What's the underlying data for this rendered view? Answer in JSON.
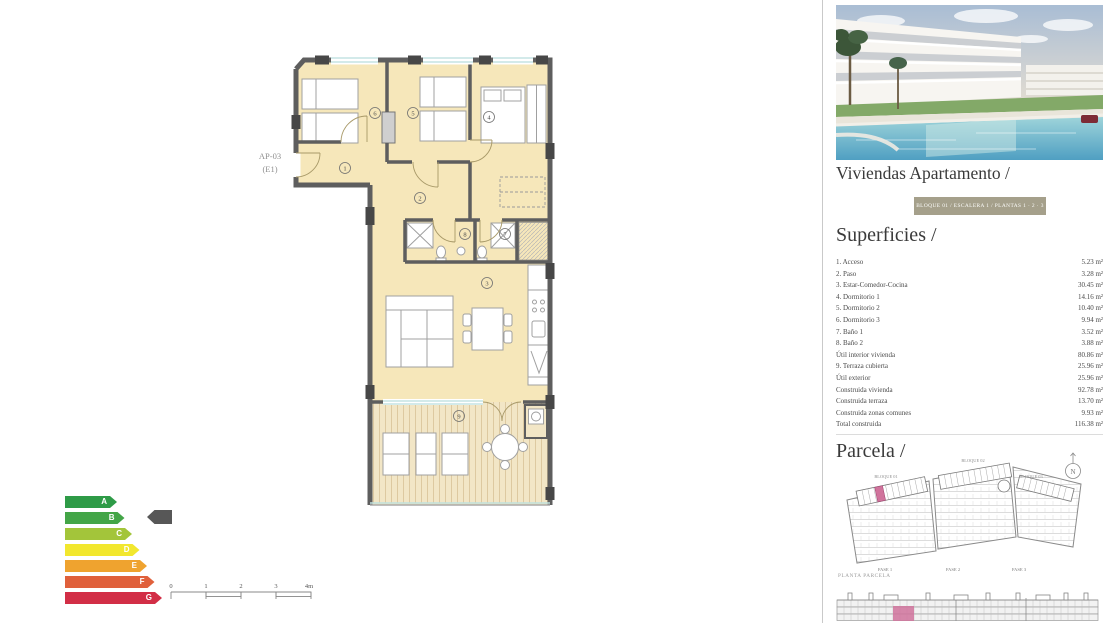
{
  "plan": {
    "unit_code": "AP-03",
    "unit_sub": "(E1)",
    "rooms": [
      {
        "num": "1"
      },
      {
        "num": "2"
      },
      {
        "num": "3"
      },
      {
        "num": "4"
      },
      {
        "num": "5"
      },
      {
        "num": "6"
      },
      {
        "num": "7"
      },
      {
        "num": "8"
      },
      {
        "num": "9"
      }
    ]
  },
  "energy": {
    "ratings": [
      {
        "letter": "A",
        "color": "#2e9b47"
      },
      {
        "letter": "B",
        "color": "#43a547"
      },
      {
        "letter": "C",
        "color": "#a3c53a"
      },
      {
        "letter": "D",
        "color": "#f2e72e"
      },
      {
        "letter": "E",
        "color": "#efa32f"
      },
      {
        "letter": "F",
        "color": "#e0603b"
      },
      {
        "letter": "G",
        "color": "#d22e46"
      }
    ],
    "arrow_rating": "B",
    "arrow_color": "#575757"
  },
  "scale_bar": {
    "labels": [
      "0",
      "1",
      "2",
      "3",
      "4m"
    ]
  },
  "right_panel": {
    "title": "Viviendas Apartamento /",
    "banner": "BLOQUE 01 / ESCALERA 1 / PLANTAS 1 · 2 · 3",
    "banner_color": "#a5a08b",
    "superficies": {
      "heading": "Superficies /",
      "rows": [
        [
          "1. Acceso",
          "5.23 m²"
        ],
        [
          "2. Paso",
          "3.28 m²"
        ],
        [
          "3. Estar-Comedor-Cocina",
          "30.45 m²"
        ],
        [
          "4. Dormitorio 1",
          "14.16 m²"
        ],
        [
          "5. Dormitorio 2",
          "10.40 m²"
        ],
        [
          "6. Dormitorio 3",
          "9.94 m²"
        ],
        [
          "7. Baño 1",
          "3.52 m²"
        ],
        [
          "8. Baño 2",
          "3.88 m²"
        ],
        [
          "Útil interior vivienda",
          "80.86 m²"
        ],
        [
          "9. Terraza cubierta",
          "25.96 m²"
        ],
        [
          "Útil exterior",
          "25.96 m²"
        ],
        [
          "Construida vivienda",
          "92.78 m²"
        ],
        [
          "Construida terraza",
          "13.70 m²"
        ],
        [
          "Construida zonas comunes",
          "9.93 m²"
        ],
        [
          "Total construida",
          "116.38 m²"
        ]
      ]
    },
    "parcela": {
      "heading": "Parcela /",
      "blocks": [
        "BLOQUE 01",
        "BLOQUE 02",
        "BLOQUE 03"
      ],
      "fases": [
        "FASE 1",
        "FASE 2",
        "FASE 3"
      ],
      "caption": "PLANTA PARCELA",
      "compass_letter": "N",
      "highlight_color": "#d0739c"
    }
  }
}
